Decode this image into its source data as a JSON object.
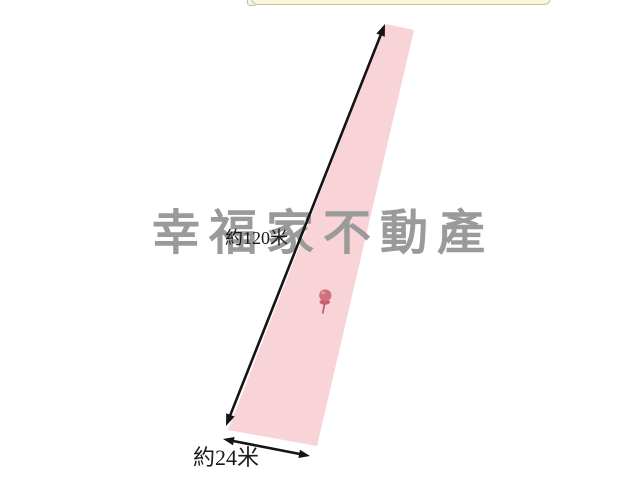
{
  "watermark": {
    "text": "幸福家不動產",
    "color": "#9A9A9A"
  },
  "parcel": {
    "shape": "elongated-quadrilateral",
    "fill": "#F8D3D7",
    "length_label": "約120米",
    "width_label": "約24米"
  },
  "annotations": {
    "arrow_color": "#141414",
    "label_color": "#1B1B1B"
  },
  "pin": {
    "head_color": "#D2707C",
    "flange_color": "#C4616E",
    "stem_color": "#C05D6B"
  },
  "tooltip_bar": {
    "fill": "#FAF7DE",
    "border_color": "#C9C096"
  }
}
